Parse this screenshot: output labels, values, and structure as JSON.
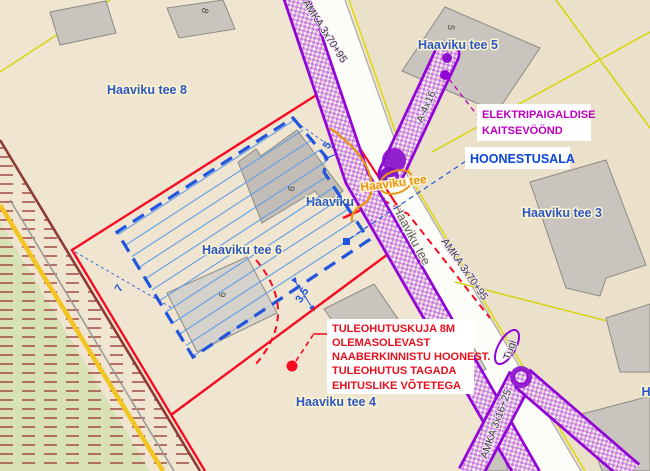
{
  "plan": {
    "parcel_labels": [
      {
        "text": "Haaviku tee 8"
      },
      {
        "text": "Haaviku tee 5"
      },
      {
        "text": "Haaviku tee 3"
      },
      {
        "text": "Haaviku tee 6"
      },
      {
        "text": "Haaviku tee 6"
      },
      {
        "text": "Haaviku tee 4"
      },
      {
        "text": "H"
      }
    ],
    "street_labels": [
      {
        "text": "Haaviku tee"
      },
      {
        "text": "Haaviku tee"
      }
    ],
    "cable_labels": [
      {
        "text": "AMKA 3x70+95"
      },
      {
        "text": "AMKA 3x70+95"
      },
      {
        "text": "A-4x16"
      },
      {
        "text": "AMKA 3x16+25"
      },
      {
        "text": "Tugi"
      }
    ],
    "dimension_labels": [
      {
        "text": "5"
      },
      {
        "text": "7"
      },
      {
        "text": "3,5"
      }
    ],
    "building_numbers": [
      {
        "text": "8"
      },
      {
        "text": "5"
      },
      {
        "text": "9"
      },
      {
        "text": "9"
      }
    ],
    "annotations": {
      "hoonestusala": {
        "text": "HOONESTUSALA",
        "color": "#0a46d8"
      },
      "kaitsevoond": {
        "lines": [
          "ELEKTRIPAIGALDISE",
          "KAITSEVÖÖND"
        ],
        "color": "#bd00bd"
      },
      "tuleohutus": {
        "lines": [
          "TULEOHUTUSKUJA 8M",
          "OLEMASOLEVAST",
          "NAABERKINNISTU HOONEST.",
          "TULEOHUTUS TAGADA",
          "EHITUSLIKE VÕTETEGA"
        ],
        "color": "#e8101e"
      }
    },
    "legend_colors": {
      "protection_zone_purple": "#9106d6",
      "building_area_blue": "#2255dd",
      "parcel_boundary_red": "#f60b22",
      "cadastral_line_yellow": "#d6d40a",
      "fire_safety_red": "#e8101e",
      "terrain_cream": "#efe5d1",
      "greenery": "#d9e2b6"
    }
  }
}
